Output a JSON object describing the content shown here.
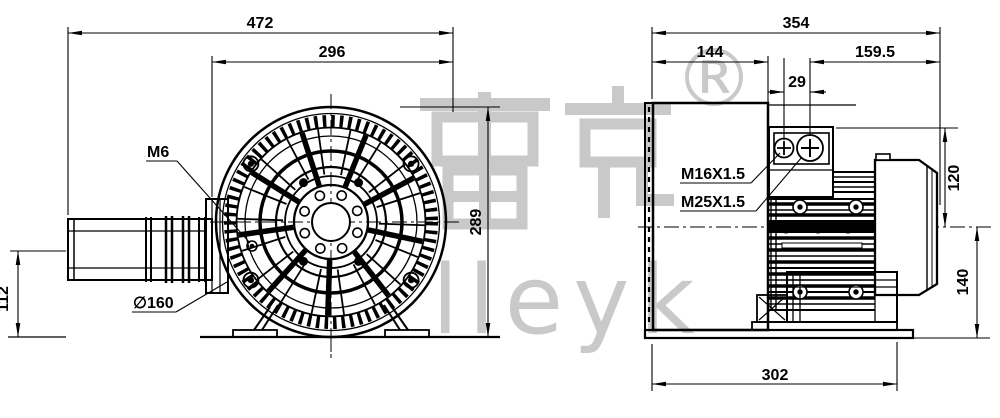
{
  "front_view": {
    "d472": "472",
    "d296": "296",
    "d289": "289",
    "d112": "112",
    "m6": "M6",
    "d160": "∅160"
  },
  "side_view": {
    "d354": "354",
    "d144": "144",
    "d1595": "159.5",
    "d29": "29",
    "d120": "120",
    "d140": "140",
    "d302": "302",
    "m16": "M16X1.5",
    "m25": "M25X1.5"
  },
  "watermark": {
    "cjk": "雷克",
    "latin": "lleyk",
    "registered": "®",
    "color": "#c9c9c9"
  },
  "colors": {
    "line": "#000000",
    "background": "#ffffff"
  }
}
